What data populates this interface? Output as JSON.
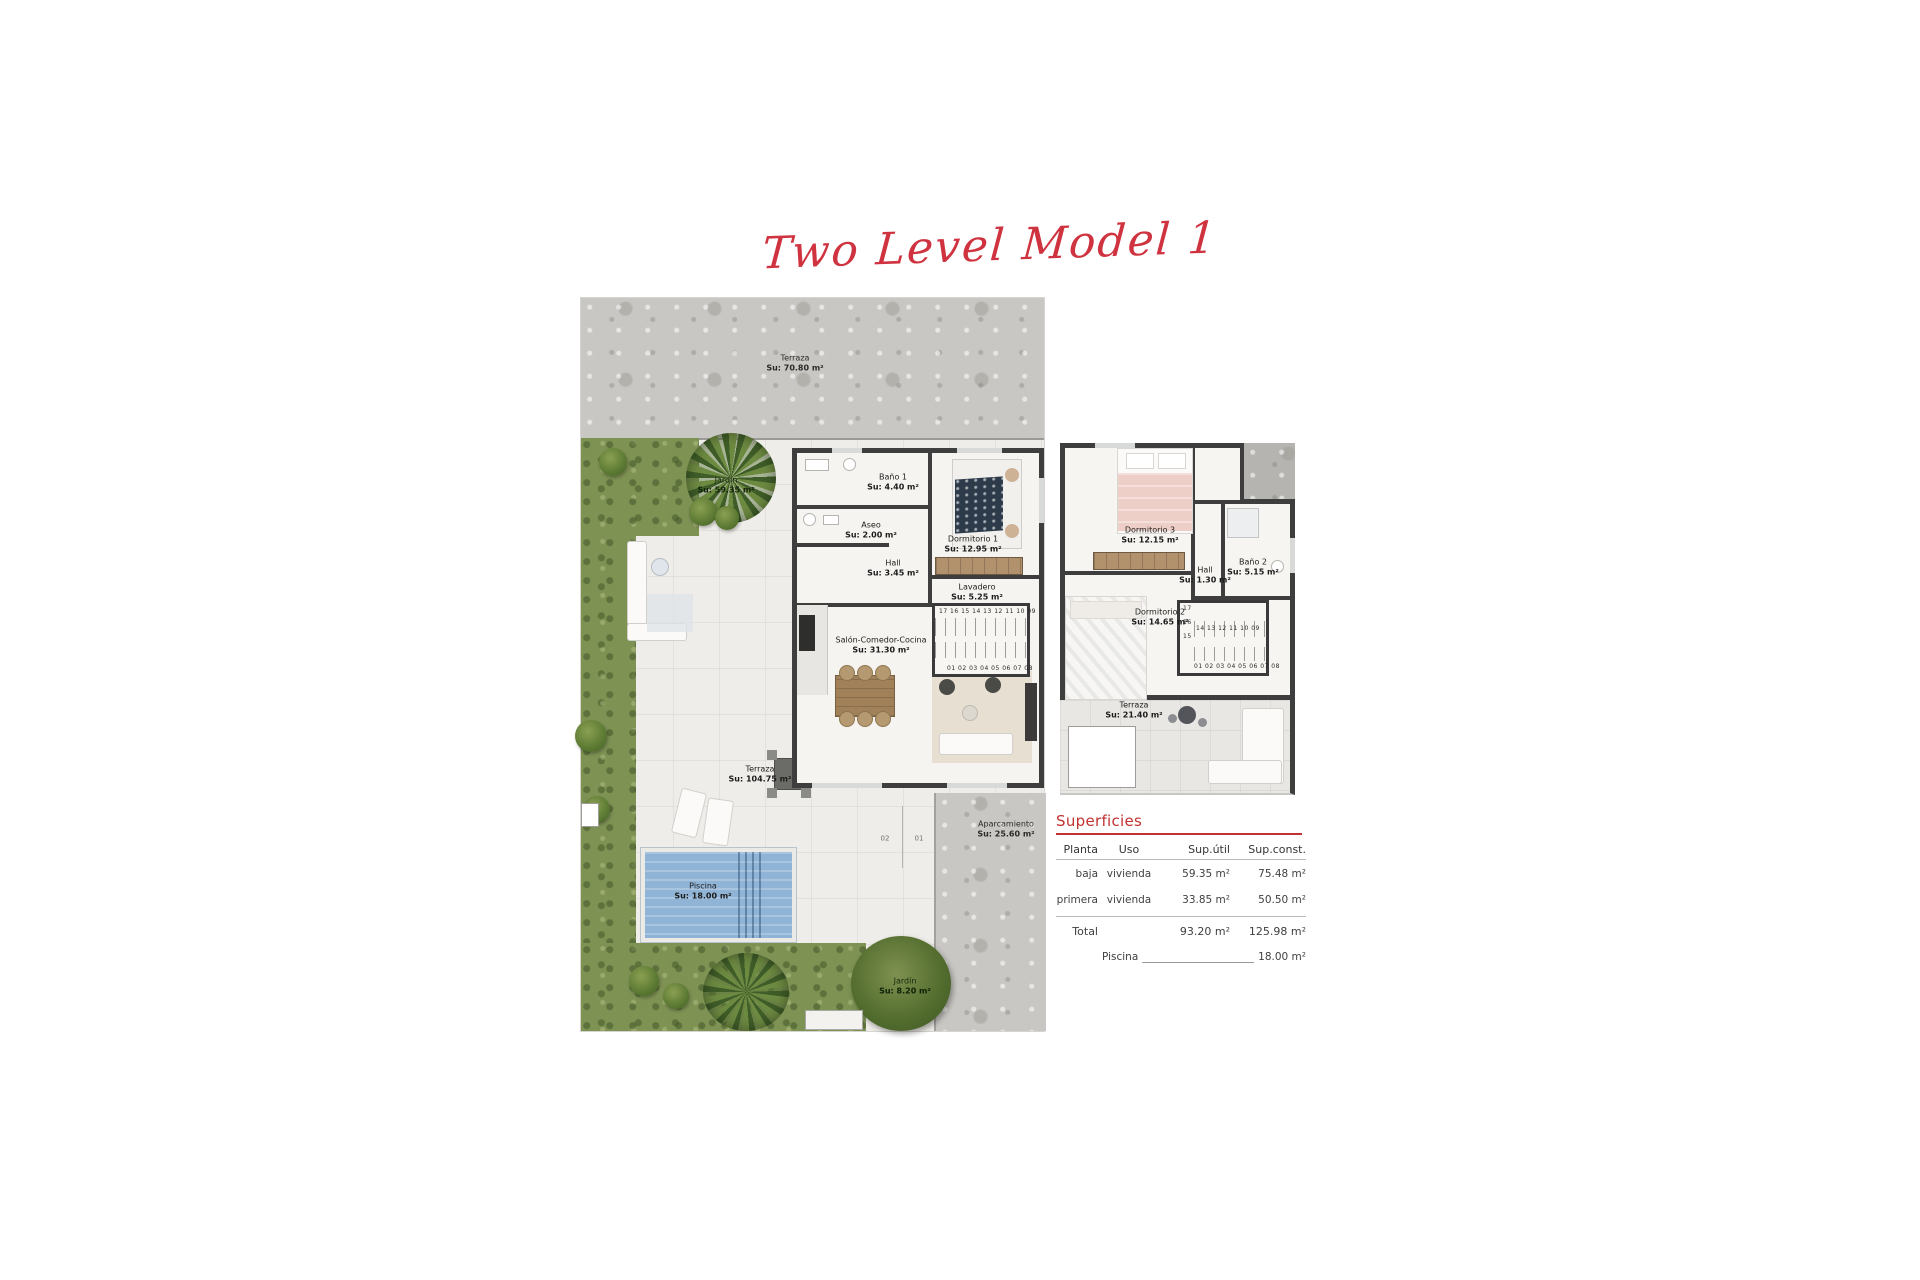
{
  "title": "Two Level Model 1",
  "colors": {
    "accent_red": "#c23131",
    "wall": "#3e3e3e",
    "pool": "#8fb4d6",
    "grass": "#7e9254"
  },
  "ground": {
    "terraza_top": {
      "name": "Terraza",
      "area": "Su: 70.80 m²"
    },
    "jardin_left": {
      "name": "Jardín",
      "area": "Su: 59.35 m²"
    },
    "bano1": {
      "name": "Baño 1",
      "area": "Su: 4.40 m²"
    },
    "aseo": {
      "name": "Aseo",
      "area": "Su: 2.00 m²"
    },
    "dorm1": {
      "name": "Dormitorio 1",
      "area": "Su: 12.95 m²"
    },
    "hall": {
      "name": "Hall",
      "area": "Su: 3.45 m²"
    },
    "lavadero": {
      "name": "Lavadero",
      "area": "Su: 5.25 m²"
    },
    "salon": {
      "name": "Salón-Comedor-Cocina",
      "area": "Su: 31.30 m²"
    },
    "terraza_main": {
      "name": "Terraza",
      "area": "Su: 104.75 m²"
    },
    "piscina": {
      "name": "Piscina",
      "area": "Su: 18.00 m²"
    },
    "aparcamiento": {
      "name": "Aparcamiento",
      "area": "Su: 25.60 m²"
    },
    "jardin_bottom": {
      "name": "Jardín",
      "area": "Su: 8.20 m²"
    },
    "stairs_upper_row": "17 16 15 14 13 12 11 10 09",
    "stairs_lower_row": "01 02 03 04 05 06 07 08",
    "parking_slot_left": "02",
    "parking_slot_right": "01"
  },
  "first": {
    "dorm3": {
      "name": "Dormitorio 3",
      "area": "Su: 12.15 m²"
    },
    "hall": {
      "name": "Hall",
      "area": "Su: 1.30 m²"
    },
    "bano2": {
      "name": "Baño 2",
      "area": "Su: 5.15 m²"
    },
    "dorm2": {
      "name": "Dormitorio 2",
      "area": "Su: 14.65 m²"
    },
    "terraza": {
      "name": "Terraza",
      "area": "Su: 21.40 m²"
    },
    "stairs_17": "17",
    "stairs_16": "16",
    "stairs_15": "15",
    "stairs_upper_row": "14 13 12 11 10 09",
    "stairs_lower_row": "01 02 03 04 05 06 07 08"
  },
  "table": {
    "title": "Superficies",
    "headers": {
      "planta": "Planta",
      "uso": "Uso",
      "sup_util": "Sup.útil",
      "sup_const": "Sup.const."
    },
    "rows": [
      {
        "planta": "baja",
        "uso": "vivienda",
        "util": "59.35 m²",
        "const": "75.48 m²"
      },
      {
        "planta": "primera",
        "uso": "vivienda",
        "util": "33.85 m²",
        "const": "50.50 m²"
      }
    ],
    "total_label": "Total",
    "total_util": "93.20 m²",
    "total_const": "125.98 m²",
    "piscina_label": "Piscina",
    "piscina_value": "18.00 m²"
  }
}
